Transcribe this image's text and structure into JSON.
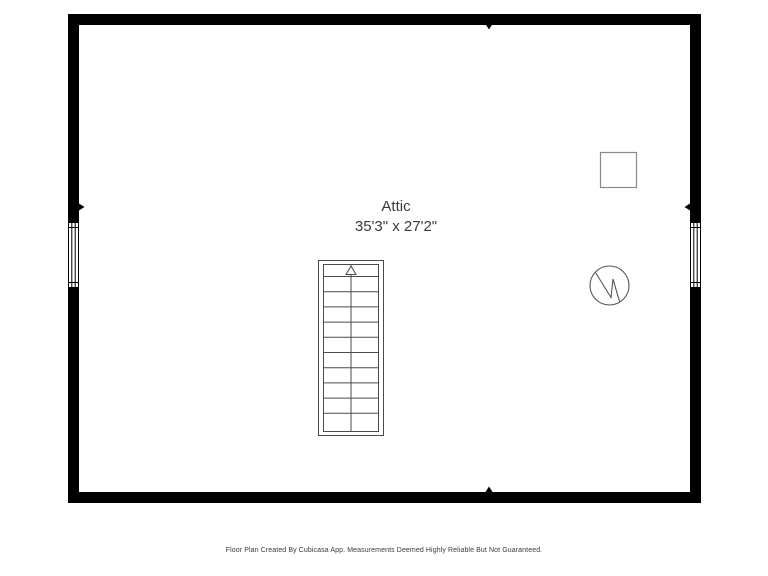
{
  "floor_plan": {
    "room": {
      "name": "Attic",
      "dimensions": "35'3\" x 27'2\""
    },
    "symbols": {
      "staircase": "straight-stair-run-with-up-arrow",
      "square_fixture": "square-outline-fixture",
      "round_fixture": "circle-with-zigzag-fixture",
      "windows": [
        "left-wall-window",
        "right-wall-window"
      ],
      "wall_markers": [
        "top-center",
        "bottom-center",
        "left-middle",
        "right-middle"
      ]
    },
    "colors": {
      "wall": "#000000",
      "stair_stroke": "#4a4a4a",
      "square_fixture_stroke": "#8a8a8a",
      "round_fixture_stroke": "#555555",
      "text": "#3a3a3a",
      "background": "#ffffff"
    }
  },
  "footer": {
    "disclaimer": "Floor Plan Created By Cubicasa App. Measurements Deemed Highly Reliable But Not Guaranteed."
  }
}
